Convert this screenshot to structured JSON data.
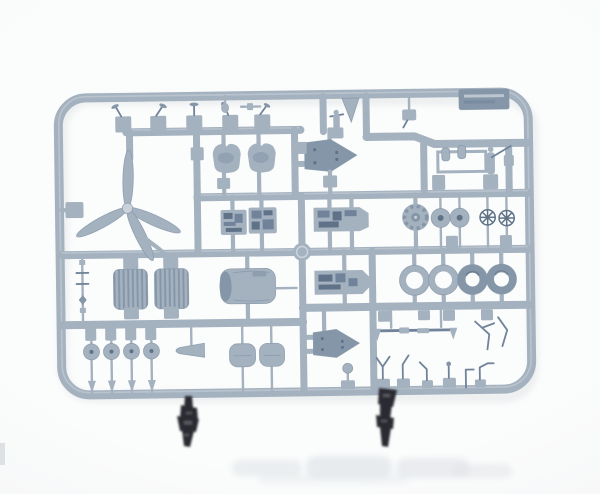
{
  "image": {
    "alt": "Photograph of a blue-grey plastic model kit sprue with aircraft parts on a white background",
    "kind": "product-photo"
  },
  "colors": {
    "bg": "#fbfcfc",
    "bgEdge": "#f2f3f4",
    "plastic": "#a4b1bf",
    "plasticLight": "#c9d2da",
    "plasticDark": "#8496a7",
    "plasticDeep": "#70839a",
    "detailDark": "#5f7288",
    "darkPart": "#2b2c30",
    "darkPartHi": "#585a61",
    "darkPartEdge": "#17181c",
    "reflection": "#e2e6e9",
    "shadow": "#dde1e4"
  },
  "sprue": {
    "label_plate_text": "",
    "parts": [
      {
        "label": "propeller",
        "count": 1
      },
      {
        "label": "propeller-blades",
        "count": 4
      },
      {
        "label": "pilot-seats",
        "count": 2
      },
      {
        "label": "cockpit-panels",
        "count": 4
      },
      {
        "label": "engine-bearers",
        "count": 2
      },
      {
        "label": "radiator-cores",
        "count": 2
      },
      {
        "label": "engine-cowling",
        "count": 1
      },
      {
        "label": "main-tires",
        "count": 4
      },
      {
        "label": "wheel-discs",
        "count": 2
      },
      {
        "label": "spoked-wheel-hubs",
        "count": 2
      },
      {
        "label": "tail-wheels",
        "count": 4
      },
      {
        "label": "cooling-fan",
        "count": 1
      },
      {
        "label": "nose-cone",
        "count": 1
      },
      {
        "label": "gear-doors",
        "count": 2
      },
      {
        "label": "control-levers",
        "count": 5
      },
      {
        "label": "antenna-masts",
        "count": 7
      },
      {
        "label": "wire-antennas",
        "count": 2
      },
      {
        "label": "pitot-mast",
        "count": 1
      },
      {
        "label": "strut-rod",
        "count": 1
      },
      {
        "label": "clear-part-frame",
        "count": 1
      },
      {
        "label": "molded-label-plate",
        "count": 1
      },
      {
        "label": "dark-plastic-parts",
        "count": 2
      }
    ]
  }
}
